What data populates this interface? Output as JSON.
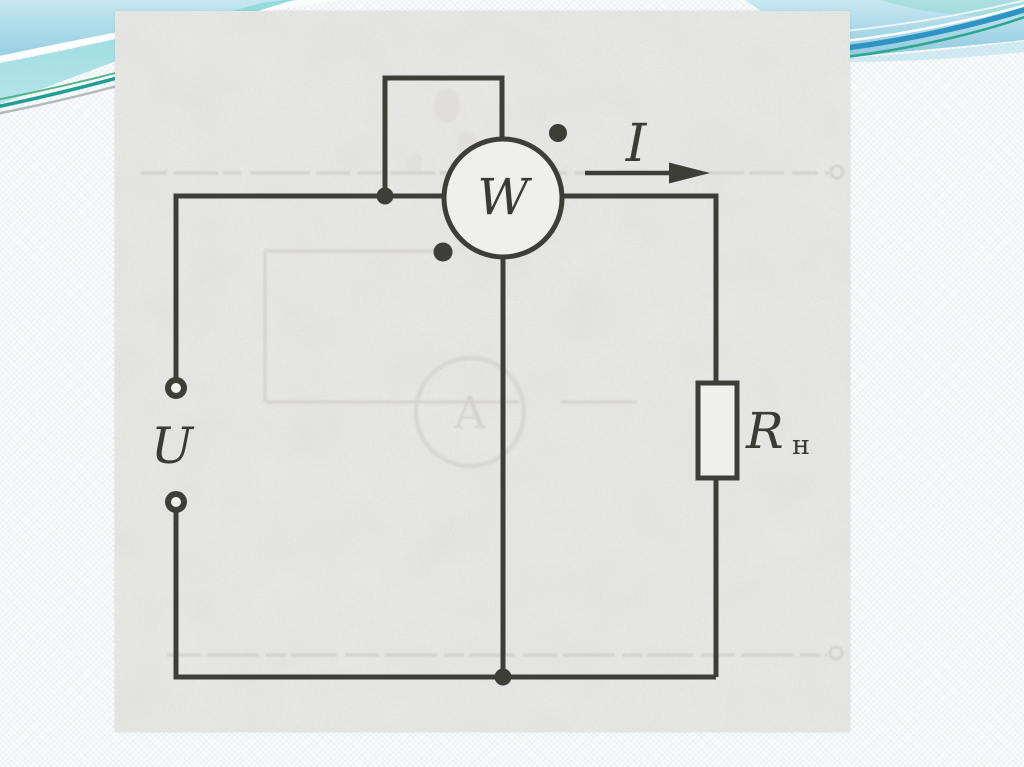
{
  "circuit": {
    "wattmeter_label": "W",
    "source_voltage_label": "U",
    "current_label": "I",
    "load_resistor_label": "R",
    "load_resistor_subscript": "н",
    "ghost_ammeter_label": "A"
  },
  "theme": {
    "slide_background": "#fcfdfd",
    "wave_band_blue_top": "#c6e7f1",
    "wave_band_blue_bottom": "#95cfe1",
    "aqua_wedge": "#8ed8da",
    "stripe_blue": "#2f93c4",
    "accent_teal": "#1f9e96",
    "accent_green": "#3aaa74",
    "accent_gray": "#9fabae",
    "aqua_tint": "#8fd6cc",
    "paper_color": "#eeeeec",
    "ink_color": "#3e3e39",
    "ghost_color": "#d3d2cd"
  }
}
